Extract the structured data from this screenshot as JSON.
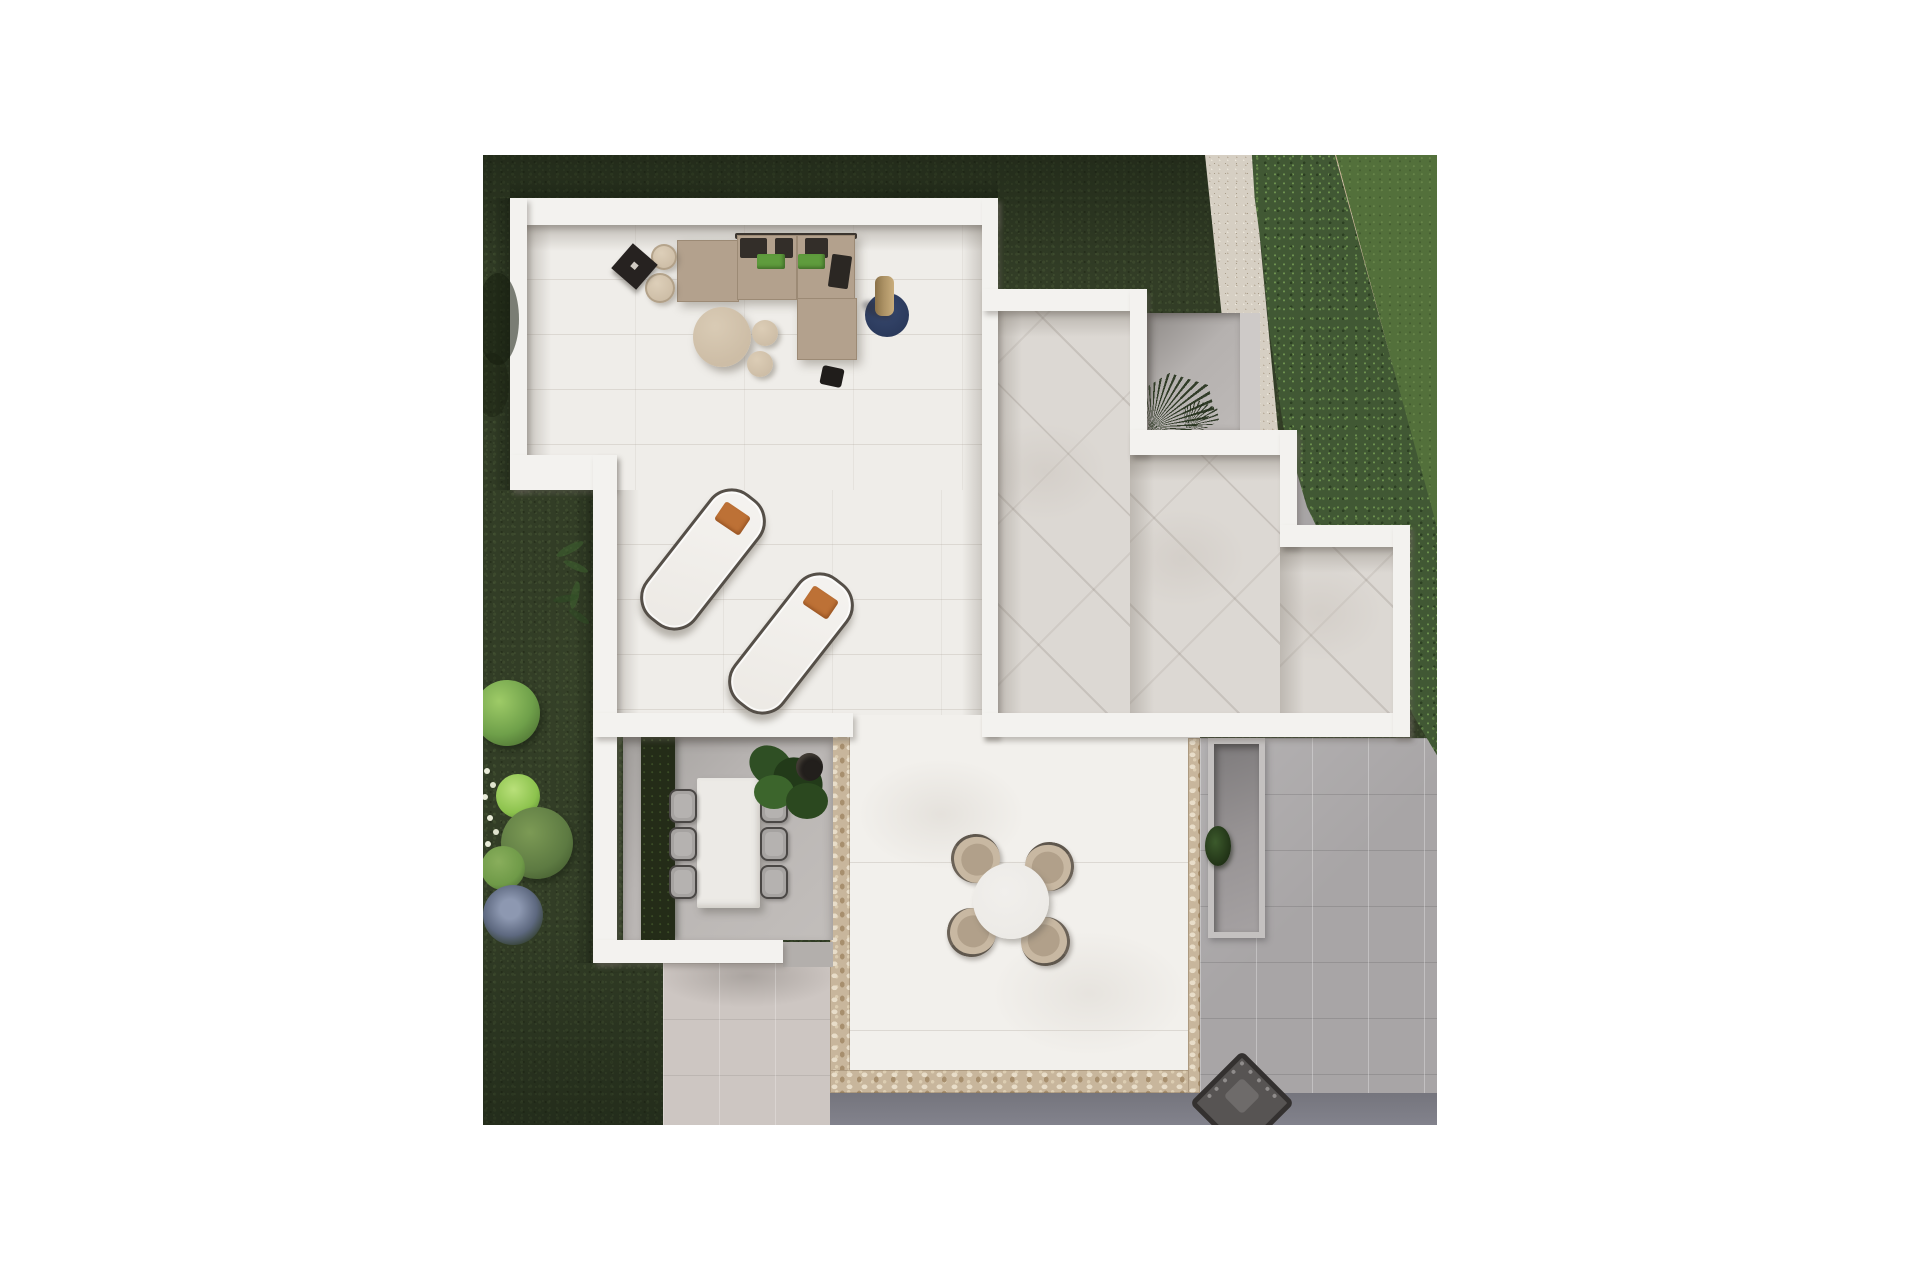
{
  "scene": {
    "type": "aerial-architectural-render",
    "description": "Top-down 3D render of a modern white villa terrace plan surrounded by dark lawn, a diagonal hedge with stone wall and gravel path at top right, gray pavement at right and bottom",
    "regions": [
      "dark-lawn",
      "bright-lawn-neighbor",
      "gravel-path",
      "boundary-stone-wall",
      "boundary-hedge",
      "roof-terrace",
      "diagonal-tiled-patio",
      "fan-palm-court",
      "dining-court",
      "central-stone-trimmed-patio",
      "sunken-entry-court",
      "right-pavement",
      "bottom-pavement",
      "dark-street-strip",
      "garden-bushes"
    ],
    "furniture": [
      "l-shaped-sofa",
      "round-coffee-table",
      "poufs",
      "cylinder-side-tables",
      "black-tray-table",
      "navy-round-rug-with-vase",
      "portable-speaker",
      "two-sun-loungers-with-orange-pillows",
      "rectangular-dining-table-with-six-chairs",
      "potted-fiddle-leaf-plant",
      "round-table-with-four-shell-chairs",
      "fan-palms",
      "barbecue-grill"
    ]
  },
  "palette": {
    "page_bg": "#ffffff",
    "grass_dark": "#323d26",
    "grass_bright": "#53703b",
    "hedge_green": "#415834",
    "wall_tan": "#c6b093",
    "gravel": "#d6cfc3",
    "pav_gray": "#a8a5a6",
    "pav_light": "#cdc6c2",
    "pav_dark": "#75757d",
    "stone_trim": "#c8b69c",
    "wall_white": "#f3f2ef",
    "floor_terrace": "#efede9",
    "floor_tiled": "#dcd8d3",
    "floor_central": "#f2f0ec",
    "court_gray": "#bdb9b7",
    "court_floor": "#b9b5b3",
    "bed_dark": "#242c18",
    "sofa_taupe": "#b3a18d",
    "cushion_dark": "#332e29",
    "cushion_green": "#5f9c3d",
    "pouf_tan": "#cdbda6",
    "rug_navy": "#2b3a5c",
    "vase_tan": "#ab9164",
    "lounger_pillow": "#bd7136",
    "table_white": "#eceae6",
    "chair_shell": "#c8b8a2",
    "chair_seat": "#b1a08a",
    "grill_dark": "#575453"
  }
}
